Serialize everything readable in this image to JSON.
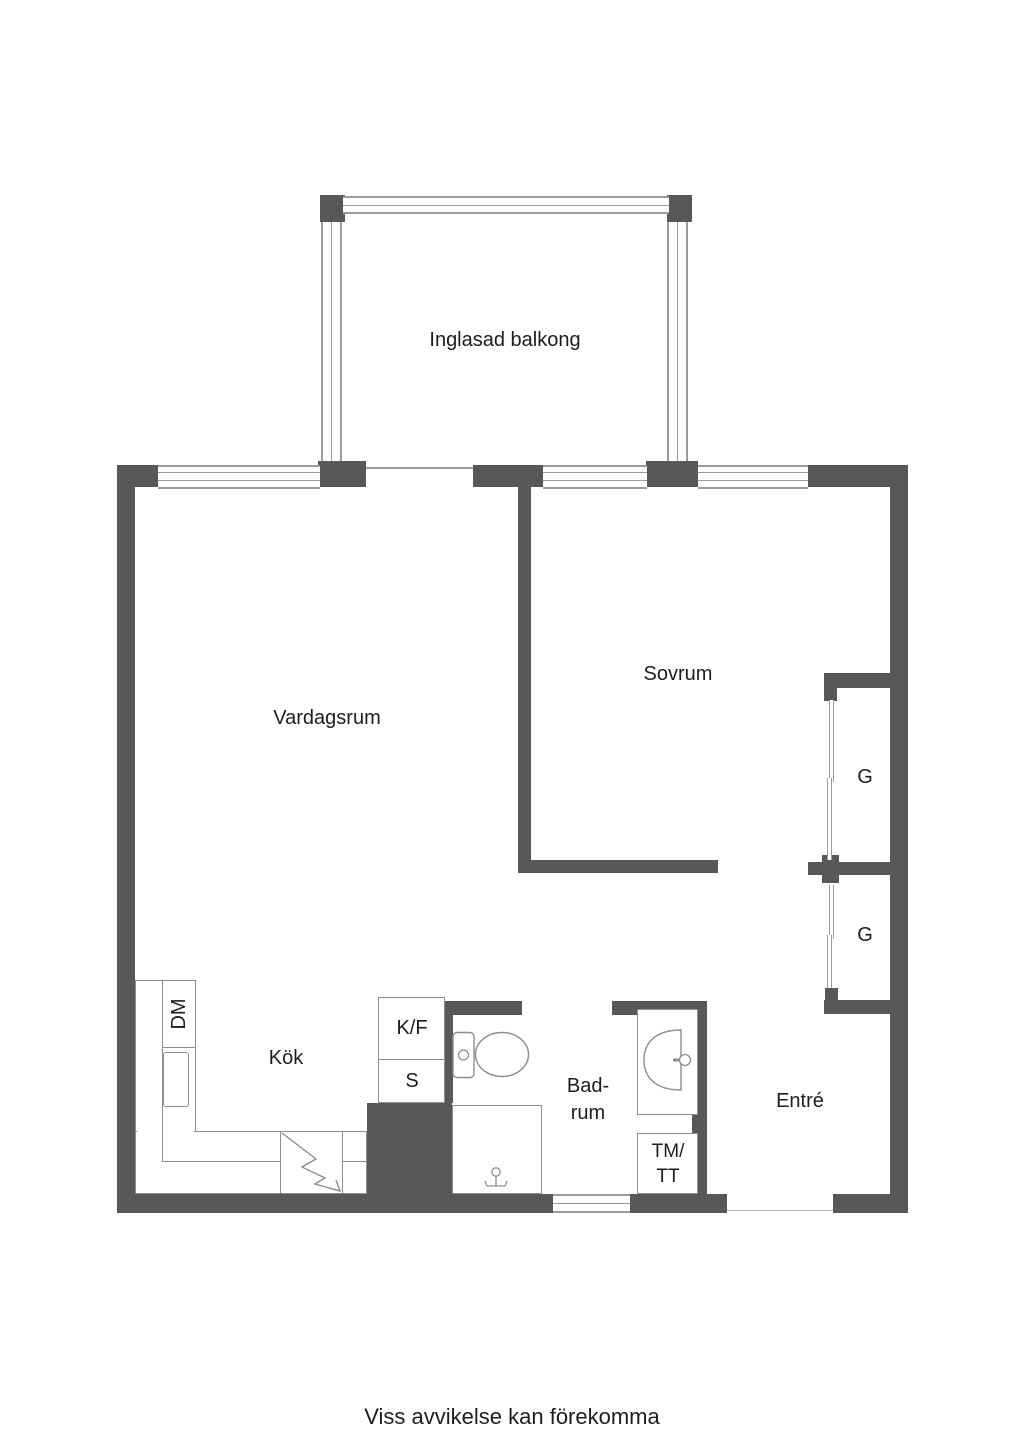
{
  "page": {
    "type": "apartment floor plan",
    "footer_note": "Viss avvikelse kan förekomma"
  },
  "colors": {
    "wall": "#575859",
    "window_line": "#9b9b9b",
    "fixture_line": "#8d8d8d",
    "text": "#1d1d1b",
    "background": "#ffffff"
  },
  "floorplan": {
    "rooms": {
      "balcony": {
        "label": "Inglasad balkong"
      },
      "living_room": {
        "label": "Vardagsrum"
      },
      "bedroom": {
        "label": "Sovrum"
      },
      "kitchen": {
        "label": "Kök"
      },
      "bathroom": {
        "label": "Bad-\nrum"
      },
      "entry": {
        "label": "Entré"
      }
    },
    "closets": {
      "wardrobe_top": "G",
      "wardrobe_bottom": "G"
    },
    "appliances": {
      "dishwasher": "DM",
      "fridge_freezer": "K/F",
      "pantry": "S",
      "washer_dryer": "TM/\nTT"
    }
  }
}
